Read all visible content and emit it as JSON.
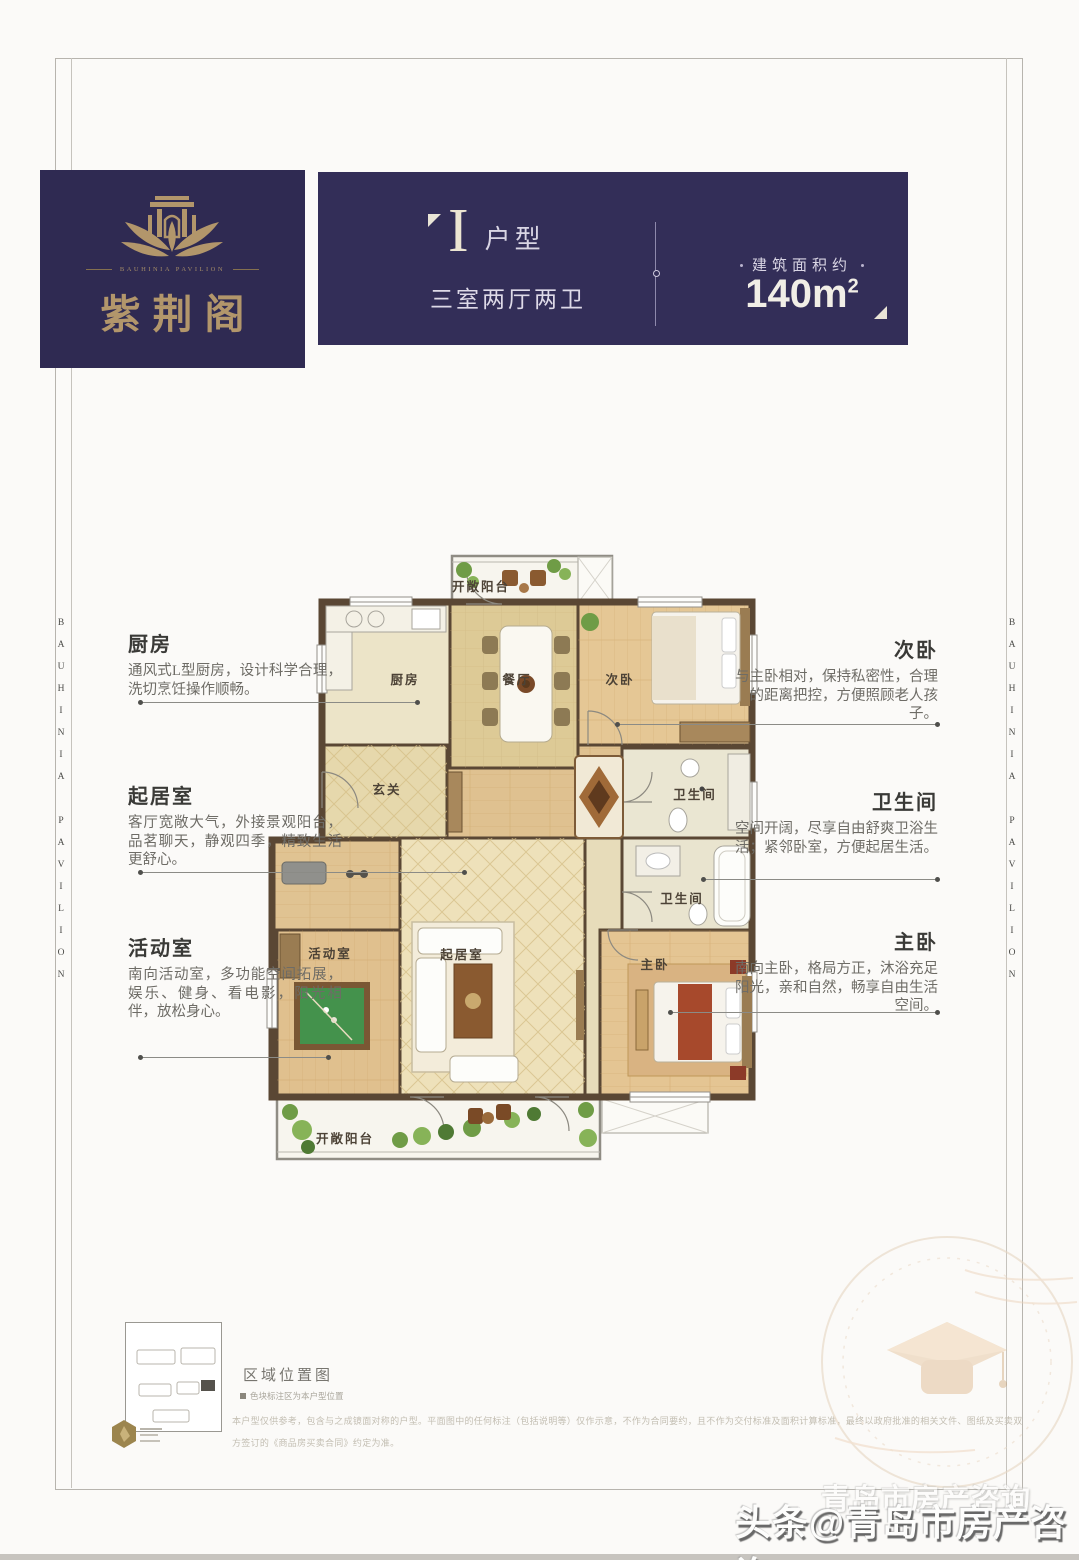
{
  "brand": {
    "logo_name": "紫荆阁",
    "logo_sub": "BAUHINIA PAVILION",
    "side_text": "BAUHINIA PAVILION"
  },
  "header": {
    "unit_letter": "I",
    "unit_label": "户型",
    "unit_desc": "三室两厅两卫",
    "area_label": "建筑面积约",
    "area_value": "140m",
    "area_sup": "2"
  },
  "callouts": {
    "left": [
      {
        "title": "厨房",
        "body": "通风式L型厨房，设计科学合理，洗切烹饪操作顺畅。"
      },
      {
        "title": "起居室",
        "body": "客厅宽敞大气，外接景观阳台，品茗聊天，静观四季，精致生活更舒心。"
      },
      {
        "title": "活动室",
        "body": "南向活动室，多功能空间拓展，娱乐、健身、看电影，阳光相伴，放松身心。"
      }
    ],
    "right": [
      {
        "title": "次卧",
        "body": "与主卧相对，保持私密性，合理的距离把控，方便照顾老人孩子。"
      },
      {
        "title": "卫生间",
        "body": "空间开阔，尽享自由舒爽卫浴生活；紧邻卧室，方便起居生活。"
      },
      {
        "title": "主卧",
        "body": "南向主卧，格局方正，沐浴充足阳光，亲和自然，畅享自由生活空间。"
      }
    ]
  },
  "floorplan": {
    "rooms": [
      {
        "label": "开敞阳台"
      },
      {
        "label": "厨房"
      },
      {
        "label": "餐厅"
      },
      {
        "label": "次卧"
      },
      {
        "label": "玄关"
      },
      {
        "label": "卫生间"
      },
      {
        "label": "卫生间"
      },
      {
        "label": "活动室"
      },
      {
        "label": "起居室"
      },
      {
        "label": "主卧"
      },
      {
        "label": "开敞阳台"
      }
    ]
  },
  "footer": {
    "map_title": "区域位置图",
    "map_note": "色块标注区为本户型位置",
    "disclaimer_line1": "本户型仅供参考，包含与之成镜面对称的户型。平面图中的任何标注（包括说明等）仅作示意，不作为合同要约，且不作为交付标准及面积计算标准，最终以政府批准的相关文件、图纸及买卖双",
    "disclaimer_line2": "方签订的《商品房买卖合同》约定为准。"
  },
  "watermark": {
    "main": "头条@青岛市房产咨询",
    "ghost": "青岛市房产咨询"
  },
  "colors": {
    "navy": "#332e58",
    "gold": "#b2966b",
    "wall": "#5a4734"
  }
}
